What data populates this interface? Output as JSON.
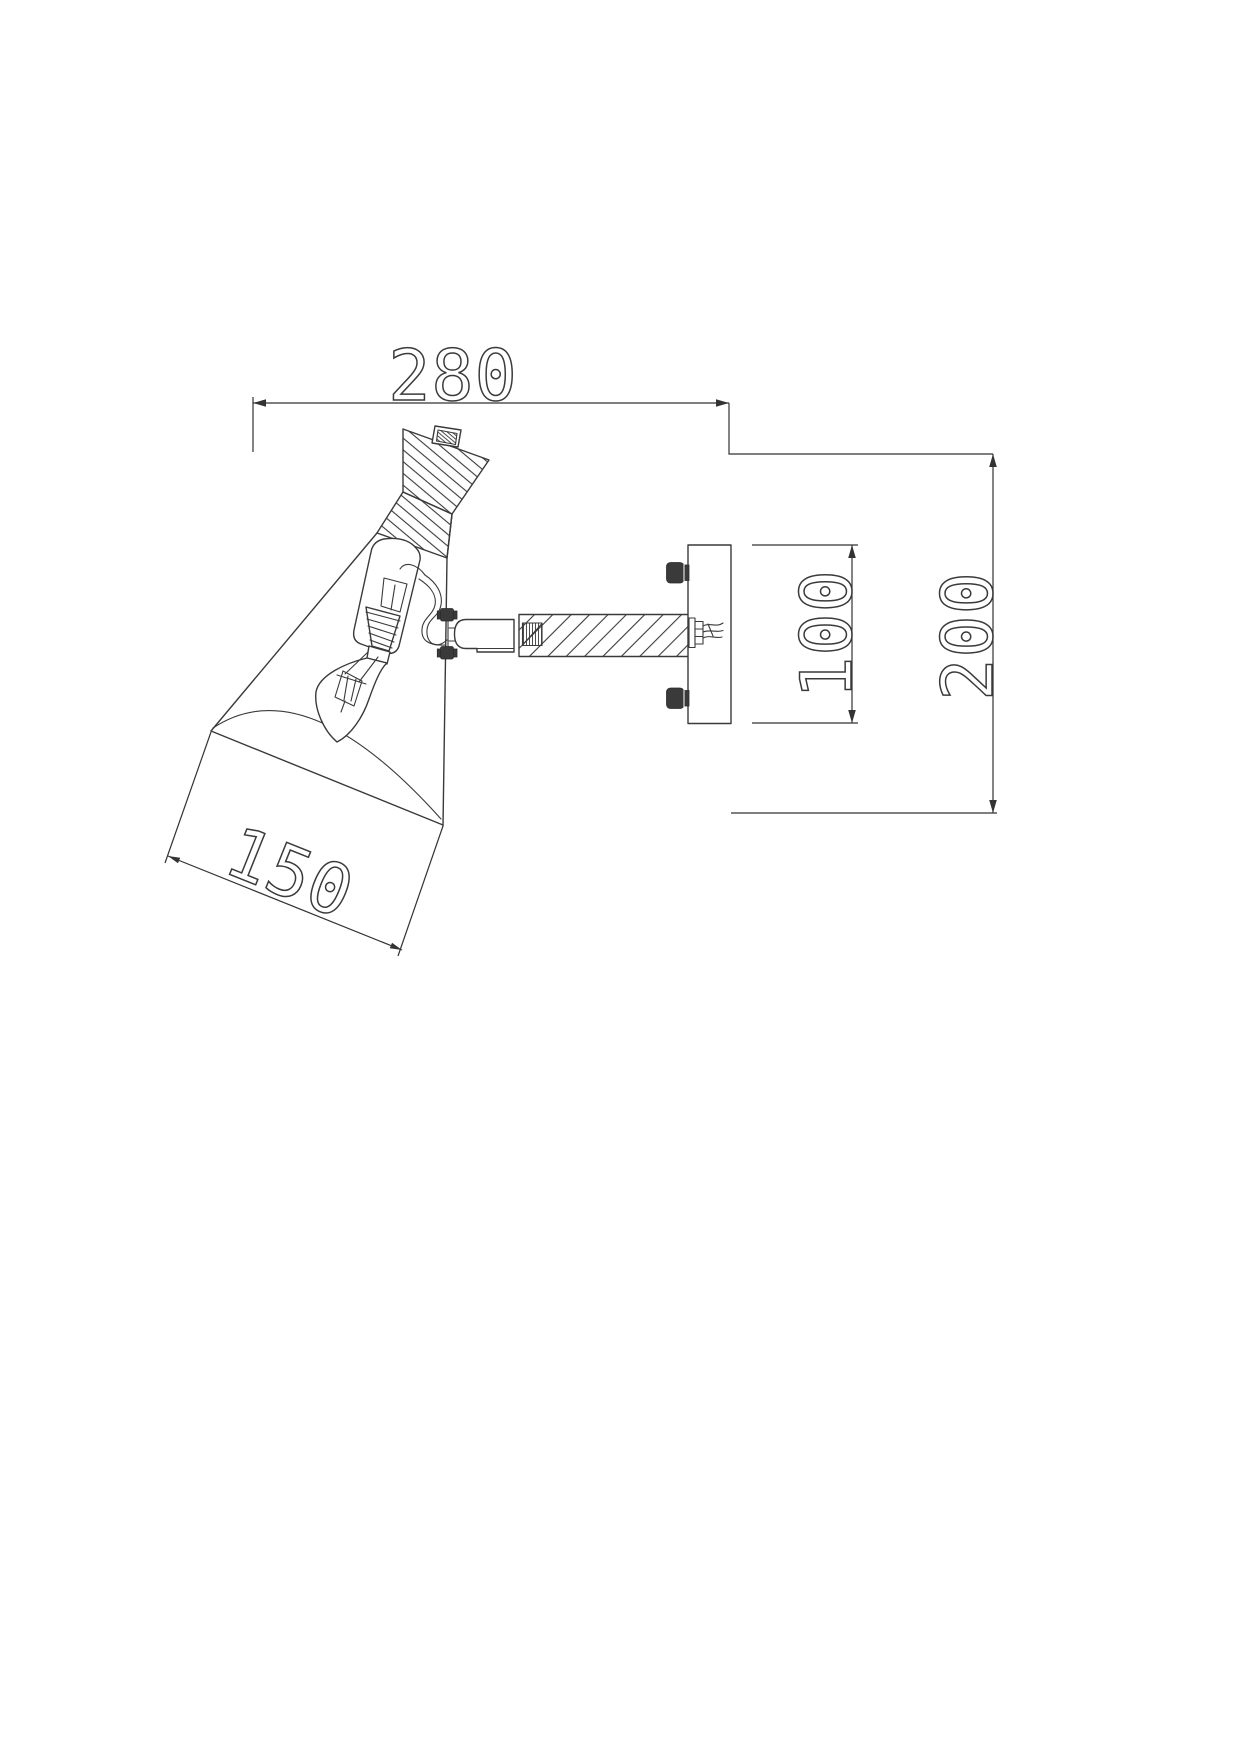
{
  "meta": {
    "type": "technical-drawing",
    "subject": "wall-mounted-spot-lamp-side-section-view"
  },
  "canvas": {
    "width": 1241,
    "height": 1754,
    "background": "#ffffff",
    "line_color": "#3a3a3a",
    "dim_color": "#333333"
  },
  "dimensions": {
    "overall_width": "280",
    "overall_height": "200",
    "backplate_height": "100",
    "shade_opening": "150"
  }
}
